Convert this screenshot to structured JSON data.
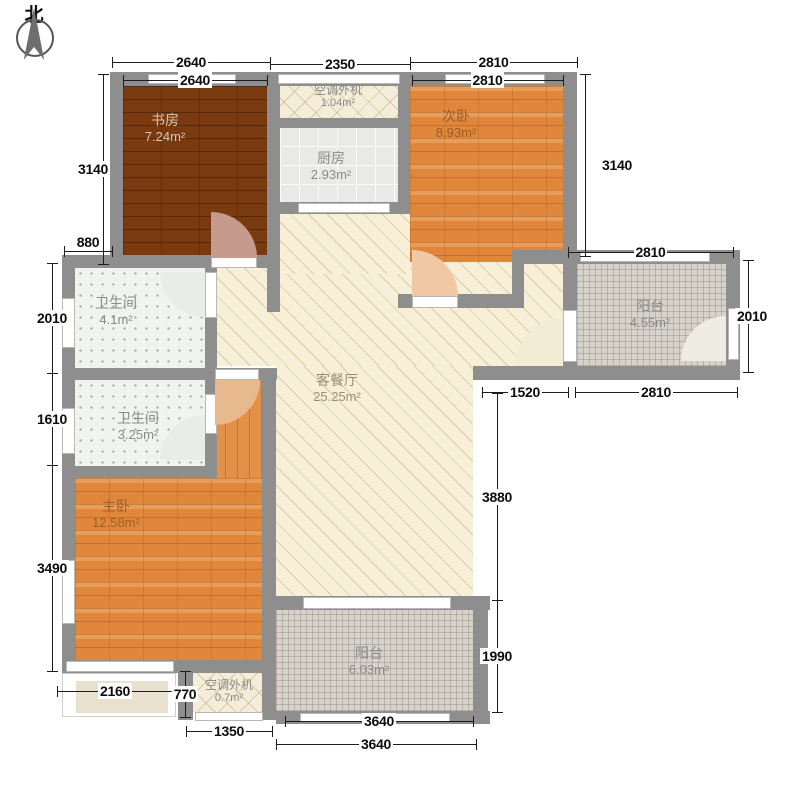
{
  "compass": {
    "label": "北"
  },
  "rooms": {
    "study": {
      "name": "书房",
      "area": "7.24m²"
    },
    "ac_top": {
      "name": "空调外机",
      "area": "1.04m²"
    },
    "kitchen": {
      "name": "厨房",
      "area": "2.93m²"
    },
    "bedroom2": {
      "name": "次卧",
      "area": "8.93m²"
    },
    "balcony_right": {
      "name": "阳台",
      "area": "4.55m²"
    },
    "living": {
      "name": "客餐厅",
      "area": "25.25m²"
    },
    "bath1": {
      "name": "卫生间",
      "area": "4.1m²"
    },
    "bath2": {
      "name": "卫生间",
      "area": "3.25m²"
    },
    "master": {
      "name": "主卧",
      "area": "12.58m²"
    },
    "ac_bottom": {
      "name": "空调外机",
      "area": "0.7m²"
    },
    "balcony_bottom": {
      "name": "阳台",
      "area": "6.03m²"
    }
  },
  "colors": {
    "wall": "#8e8e8e",
    "dark_wood": "#7a3a10",
    "orange_wood": "#e0873c",
    "cream_floor": "#f8efd9",
    "tile": "#d7d3cb"
  },
  "dimensions": [
    {
      "label": "2640",
      "dir": "h",
      "x": 112,
      "y": 62,
      "len": 158
    },
    {
      "label": "2350",
      "dir": "h",
      "x": 270,
      "y": 64,
      "len": 140
    },
    {
      "label": "2810",
      "dir": "h",
      "x": 410,
      "y": 62,
      "len": 167
    },
    {
      "label": "2640",
      "dir": "h",
      "x": 123,
      "y": 80,
      "len": 144
    },
    {
      "label": "2810",
      "dir": "h",
      "x": 412,
      "y": 80,
      "len": 151
    },
    {
      "label": "3140",
      "dir": "v",
      "x": 103,
      "y": 74,
      "len": 190,
      "dx": -10
    },
    {
      "label": "880",
      "dir": "h",
      "x": 64,
      "y": 251,
      "len": 48,
      "dy": -9
    },
    {
      "label": "2010",
      "dir": "v",
      "x": 52,
      "y": 263,
      "len": 110
    },
    {
      "label": "1610",
      "dir": "v",
      "x": 52,
      "y": 373,
      "len": 92
    },
    {
      "label": "3490",
      "dir": "v",
      "x": 52,
      "y": 465,
      "len": 206
    },
    {
      "label": "2160",
      "dir": "h",
      "x": 57,
      "y": 691,
      "len": 116
    },
    {
      "label": "770",
      "dir": "v",
      "x": 185,
      "y": 671,
      "len": 46
    },
    {
      "label": "1350",
      "dir": "h",
      "x": 186,
      "y": 731,
      "len": 86
    },
    {
      "label": "3640",
      "dir": "h",
      "x": 285,
      "y": 721,
      "len": 188
    },
    {
      "label": "3640",
      "dir": "h",
      "x": 276,
      "y": 744,
      "len": 200
    },
    {
      "label": "3140",
      "dir": "v",
      "x": 585,
      "y": 74,
      "len": 182,
      "dx": 32
    },
    {
      "label": "2810",
      "dir": "h",
      "x": 568,
      "y": 252,
      "len": 165
    },
    {
      "label": "2010",
      "dir": "v",
      "x": 748,
      "y": 260,
      "len": 112,
      "dx": 4
    },
    {
      "label": "2810",
      "dir": "h",
      "x": 575,
      "y": 392,
      "len": 162
    },
    {
      "label": "1520",
      "dir": "h",
      "x": 482,
      "y": 392,
      "len": 86
    },
    {
      "label": "3880",
      "dir": "v",
      "x": 497,
      "y": 393,
      "len": 207
    },
    {
      "label": "1990",
      "dir": "v",
      "x": 497,
      "y": 600,
      "len": 112
    }
  ]
}
